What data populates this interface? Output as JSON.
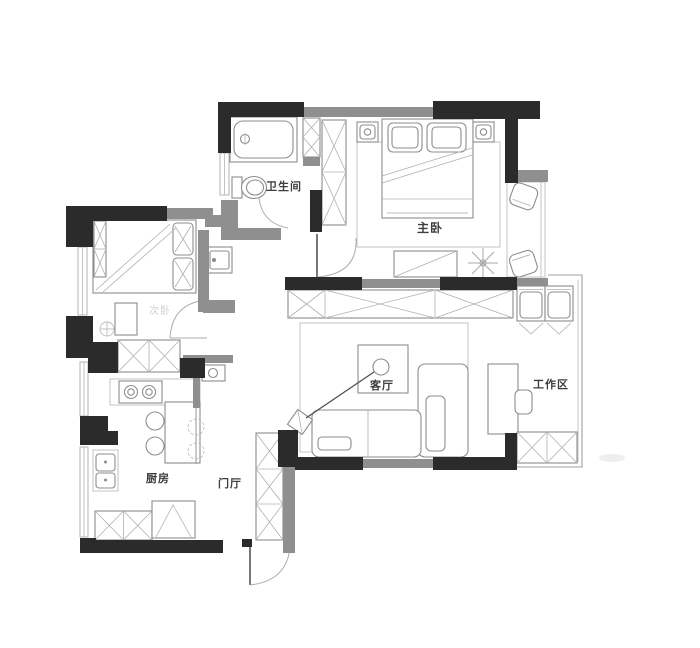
{
  "page": {
    "background": "#ffffff"
  },
  "colors": {
    "wall_black": "#2b2b2b",
    "wall_gray": "#8f8f8f",
    "furniture_line": "#8d8d8d",
    "light_line": "#bdbdbd",
    "label_color": "#3d3d3d",
    "faint_label_color": "#cfcfcf"
  },
  "rooms": {
    "bathroom": {
      "label": "卫生间"
    },
    "master_bedroom": {
      "label": "主卧"
    },
    "second_bedroom": {
      "label": "次卧"
    },
    "living_room": {
      "label": "客厅"
    },
    "work_area": {
      "label": "工作区"
    },
    "kitchen": {
      "label": "厨房"
    },
    "entry_hall": {
      "label": "门厅"
    }
  }
}
